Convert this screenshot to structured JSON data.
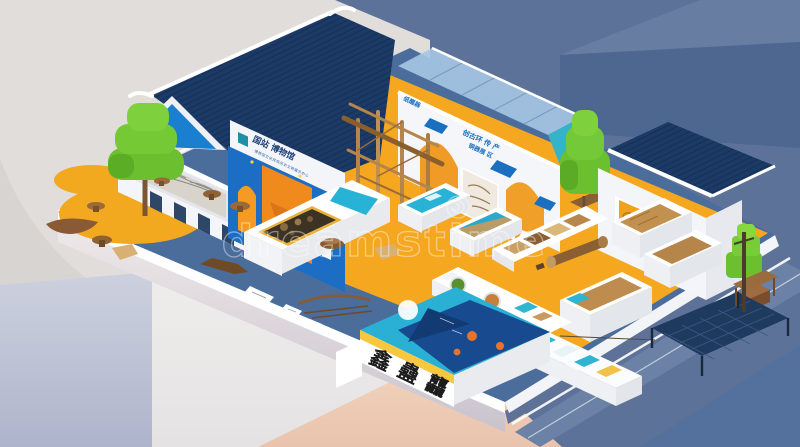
{
  "watermark": {
    "text": "dreamstime",
    "logo": "dreamstime-spiral"
  },
  "signs": {
    "main_building": {
      "title": "国站 博物馆",
      "subtitle": "博物馆文化民俗历史文物展示中心"
    },
    "courtyard_wall": {
      "vertical": "纸醒器",
      "line1": "创古环 传 产",
      "line2": "铜器展 区"
    },
    "front_display": {
      "char1": "鑫",
      "char2": "蠱",
      "char3": "龘"
    }
  },
  "palette": {
    "bg_cream": "#d8d4d1",
    "bg_cream_light": "#e3dfdc",
    "bg_slate": "#5c7298",
    "bg_slate_dark": "#4d6791",
    "bg_slate_light": "#677da1",
    "bg_lavender": "#b9bed2",
    "bg_white_block": "#f2f0ee",
    "bg_peach": "#eecdb4",
    "floor_blue": "#4b6d9c",
    "floor_orange": "#f5a71f",
    "platform_side_right": "#5d7296",
    "street_band": "#6b81a5",
    "wall_white": "#f4f5f8",
    "wall_shade": "#e7e9ee",
    "roof_navy": "#1c3a66",
    "gable_blue": "#1b7fd0",
    "mural_blue": "#1b6ec4",
    "mural_orange": "#f08a1d",
    "accent_blue": "#1a6fc0",
    "teal_screen": "#28b2d6",
    "glass_blue": "#a6c6e4",
    "glass_teal": "#35b3c9",
    "tree_green": "#6cc02f",
    "tree_green_dark": "#55a322",
    "tree_green_light": "#7ed13c",
    "wood_brown": "#9a6a3a",
    "tan_exhibit": "#c3914f",
    "net_navy": "#1e3a5e",
    "sun_yellow": "#f2a81f",
    "label_yellow": "#f7c83f",
    "ink_black": "#1c1c1c",
    "watermark_white": "#ffffff"
  }
}
